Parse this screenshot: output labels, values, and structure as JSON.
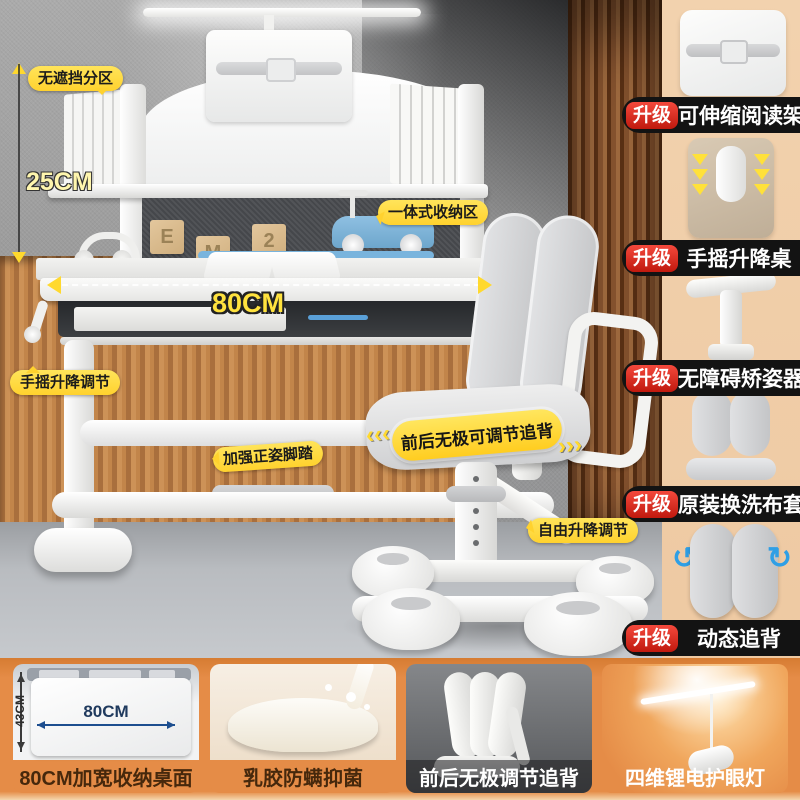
{
  "colors": {
    "accent_yellow": "#FFD92E",
    "badge_red": "#D92A1E",
    "pill_black": "#131313",
    "sidebar_peach": "#EFCCA7",
    "bottom_orange": "#E58C47",
    "caption_brown": "#46280C",
    "measure_blue": "#1D4E8F",
    "wood_wall": "#C98E58",
    "curtain_brown": "#8A5530"
  },
  "scene": {
    "labels": {
      "partition": "无遮挡分区",
      "shelf_height": "25CM",
      "storage": "一体式收纳区",
      "desk_width": "80CM",
      "crank": "手摇升降调节",
      "footrest": "加强正姿脚踏",
      "seat_adjust": "前后无极可调节追背",
      "seat_adjust_left_arrows": "‹‹‹",
      "seat_adjust_right_arrows": "›››",
      "chair_lift": "自由升降调节"
    },
    "blocks": [
      "E",
      "M",
      "2"
    ]
  },
  "sidebar": {
    "badge": "升级",
    "items": [
      {
        "label": "可伸缩阅读架",
        "image": "retractable-reading-stand"
      },
      {
        "label": "手摇升降桌",
        "image": "hand-crank-lift-desk"
      },
      {
        "label": "无障碍矫姿器",
        "image": "posture-corrector"
      },
      {
        "label": "原装换洗布套",
        "image": "washable-fabric-cover"
      },
      {
        "label": "动态追背",
        "image": "dynamic-back-support"
      }
    ]
  },
  "bottom_panels": [
    {
      "caption": "80CM加宽收纳桌面",
      "width_label": "80CM",
      "height_label": "43CM"
    },
    {
      "caption": "乳胶防螨抑菌"
    },
    {
      "caption": "前后无极调节追背"
    },
    {
      "caption": "四维锂电护眼灯"
    }
  ]
}
